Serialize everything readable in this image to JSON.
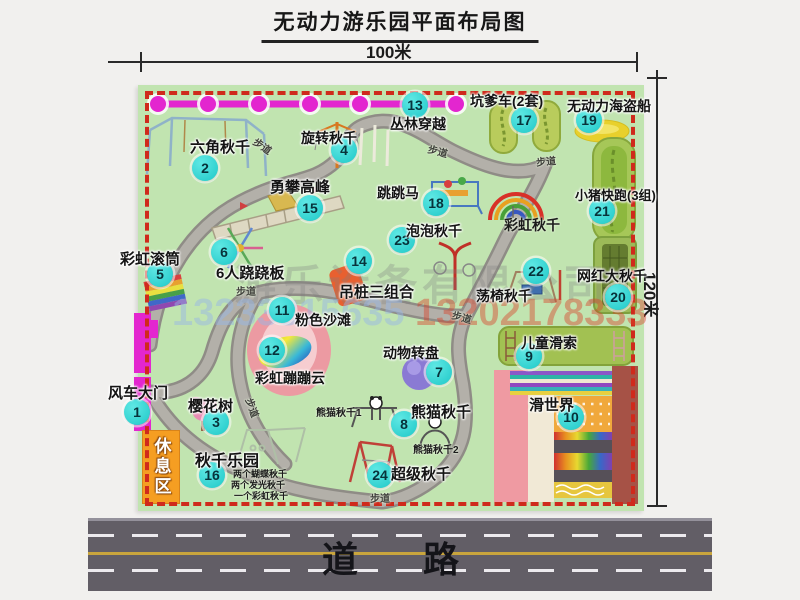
{
  "title": "无动力游乐园平面布局图",
  "dimensions": {
    "width": "100米",
    "height": "120米"
  },
  "road": {
    "label": "道路"
  },
  "rest_area": {
    "label": "休息区"
  },
  "watermark": {
    "phone_left": "13233815635",
    "phone_right": "13202178333",
    "company": "游乐设备有限公司"
  },
  "map": {
    "attractions": [
      {
        "num": "1",
        "name": "风车大门",
        "badge": {
          "x": 137,
          "y": 412
        },
        "label": {
          "x": 108,
          "y": 382,
          "fs": 15
        }
      },
      {
        "num": "2",
        "name": "六角秋千",
        "badge": {
          "x": 205,
          "y": 168
        },
        "label": {
          "x": 190,
          "y": 136,
          "fs": 15
        }
      },
      {
        "num": "3",
        "name": "樱花树",
        "badge": {
          "x": 216,
          "y": 422
        },
        "label": {
          "x": 188,
          "y": 395,
          "fs": 15
        }
      },
      {
        "num": "4",
        "name": "旋转秋千",
        "badge": {
          "x": 344,
          "y": 150
        },
        "label": {
          "x": 301,
          "y": 128,
          "fs": 14
        }
      },
      {
        "num": "5",
        "name": "彩虹滚筒",
        "badge": {
          "x": 160,
          "y": 274
        },
        "label": {
          "x": 120,
          "y": 248,
          "fs": 15
        }
      },
      {
        "num": "6",
        "name": "6人跷跷板",
        "badge": {
          "x": 224,
          "y": 252
        },
        "label": {
          "x": 216,
          "y": 262,
          "fs": 15
        }
      },
      {
        "num": "7",
        "name": "动物转盘",
        "badge": {
          "x": 439,
          "y": 372
        },
        "label": {
          "x": 383,
          "y": 343,
          "fs": 14
        }
      },
      {
        "num": "8",
        "name": "熊猫秋千",
        "badge": {
          "x": 404,
          "y": 424
        },
        "label": {
          "x": 411,
          "y": 401,
          "fs": 15
        }
      },
      {
        "num": "9",
        "name": "儿童滑索",
        "badge": {
          "x": 529,
          "y": 356
        },
        "label": {
          "x": 521,
          "y": 333,
          "fs": 14
        }
      },
      {
        "num": "10",
        "name": "滑世界",
        "badge": {
          "x": 571,
          "y": 417
        },
        "label": {
          "x": 529,
          "y": 394,
          "fs": 15
        }
      },
      {
        "num": "11",
        "name": "粉色沙滩",
        "badge": {
          "x": 282,
          "y": 310
        },
        "label": {
          "x": 295,
          "y": 310,
          "fs": 14
        }
      },
      {
        "num": "12",
        "name": "彩虹蹦蹦云",
        "badge": {
          "x": 272,
          "y": 350
        },
        "label": {
          "x": 255,
          "y": 368,
          "fs": 14
        }
      },
      {
        "num": "13",
        "name": "丛林穿越",
        "badge": {
          "x": 415,
          "y": 105
        },
        "label": {
          "x": 390,
          "y": 114,
          "fs": 14
        }
      },
      {
        "num": "14",
        "name": "吊桩三组合",
        "badge": {
          "x": 359,
          "y": 261
        },
        "label": {
          "x": 339,
          "y": 281,
          "fs": 15
        }
      },
      {
        "num": "15",
        "name": "勇攀高峰",
        "badge": {
          "x": 310,
          "y": 208
        },
        "label": {
          "x": 270,
          "y": 176,
          "fs": 15
        }
      },
      {
        "num": "16",
        "name": "秋千乐园",
        "badge": {
          "x": 212,
          "y": 475
        },
        "label": {
          "x": 195,
          "y": 447,
          "fs": 16
        }
      },
      {
        "num": "17",
        "name": "坑爹车(2套)",
        "badge": {
          "x": 524,
          "y": 120
        },
        "label": {
          "x": 470,
          "y": 91,
          "fs": 14
        }
      },
      {
        "num": "18",
        "name": "跳跳马",
        "badge": {
          "x": 436,
          "y": 203
        },
        "label": {
          "x": 377,
          "y": 183,
          "fs": 14
        }
      },
      {
        "num": "19",
        "name": "无动力海盗船",
        "badge": {
          "x": 589,
          "y": 120
        },
        "label": {
          "x": 567,
          "y": 96,
          "fs": 14
        }
      },
      {
        "num": "20",
        "name": "网红大秋千",
        "badge": {
          "x": 618,
          "y": 297
        },
        "label": {
          "x": 577,
          "y": 266,
          "fs": 14
        }
      },
      {
        "num": "21",
        "name": "小猪快跑(3组)",
        "badge": {
          "x": 602,
          "y": 211
        },
        "label": {
          "x": 575,
          "y": 185,
          "fs": 13
        }
      },
      {
        "num": "22",
        "name": "荡椅秋千",
        "badge": {
          "x": 536,
          "y": 271
        },
        "label": {
          "x": 476,
          "y": 286,
          "fs": 14
        }
      },
      {
        "num": "23",
        "name": "泡泡秋千",
        "badge": {
          "x": 402,
          "y": 240
        },
        "label": {
          "x": 406,
          "y": 221,
          "fs": 14
        }
      },
      {
        "num": "24",
        "name": "超级秋千",
        "badge": {
          "x": 380,
          "y": 475
        },
        "label": {
          "x": 391,
          "y": 463,
          "fs": 15
        }
      }
    ],
    "texts": [
      {
        "text": "彩虹秋千",
        "x": 504,
        "y": 215,
        "fs": 14,
        "name": "label-rainbow-swing"
      },
      {
        "text": "熊猫秋千1",
        "x": 316,
        "y": 404,
        "fs": 10,
        "name": "label-panda-swing-1"
      },
      {
        "text": "熊猫秋千2",
        "x": 413,
        "y": 441,
        "fs": 10,
        "name": "label-panda-swing-2"
      },
      {
        "text": "两个蝴蝶秋千",
        "x": 233,
        "y": 467,
        "fs": 9,
        "name": "note-two-butterfly-swings"
      },
      {
        "text": "两个发光秋千",
        "x": 231,
        "y": 478,
        "fs": 9,
        "name": "note-two-glowing-swings"
      },
      {
        "text": "一个彩虹秋千",
        "x": 234,
        "y": 489,
        "fs": 9,
        "name": "note-one-rainbow-swing"
      },
      {
        "text": "步道",
        "x": 253,
        "y": 138,
        "fs": 10,
        "r": 35,
        "cls": "trail",
        "name": "trail-label"
      },
      {
        "text": "步道",
        "x": 428,
        "y": 143,
        "fs": 10,
        "r": 15,
        "cls": "trail",
        "name": "trail-label"
      },
      {
        "text": "步道",
        "x": 536,
        "y": 153,
        "fs": 10,
        "r": -5,
        "cls": "trail",
        "name": "trail-label"
      },
      {
        "text": "步道",
        "x": 236,
        "y": 283,
        "fs": 10,
        "r": 0,
        "cls": "trail",
        "name": "trail-label"
      },
      {
        "text": "步道",
        "x": 452,
        "y": 309,
        "fs": 10,
        "r": 15,
        "cls": "trail",
        "name": "trail-label"
      },
      {
        "text": "步道",
        "x": 370,
        "y": 490,
        "fs": 10,
        "r": 0,
        "cls": "trail",
        "name": "trail-label"
      },
      {
        "text": "步道",
        "x": 243,
        "y": 400,
        "fs": 10,
        "r": 70,
        "cls": "trail",
        "name": "trail-label"
      }
    ]
  }
}
